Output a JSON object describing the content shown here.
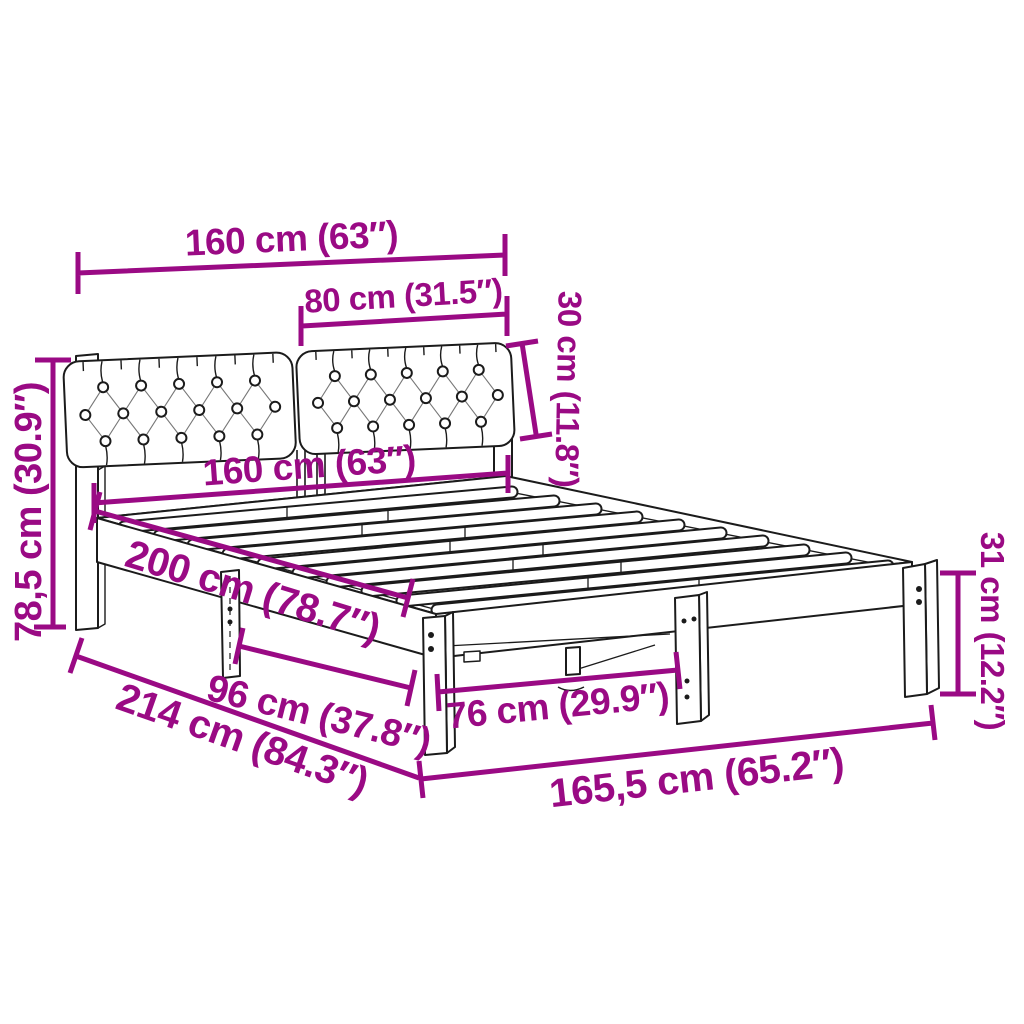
{
  "title": "Bed frame with tufted headboard - dimension diagram",
  "colors": {
    "dimension_accent": "#9a0a84",
    "line_art": "#1b1b1b",
    "background": "#ffffff"
  },
  "dimensions": {
    "headboard_width": "160 cm (63″)",
    "cushion_width": "80 cm (31.5″)",
    "cushion_height": "30 cm (11.8″)",
    "mattress_width": "160 cm (63″)",
    "headboard_height": "78,5 cm (30.9″)",
    "mattress_length": "200 cm (78.7″)",
    "side_leg_spacing": "96 cm (37.8″)",
    "total_length": "214 cm (84.3″)",
    "foot_leg_spacing": "76 cm (29.9″)",
    "frame_width": "165,5 cm (65.2″)",
    "frame_height": "31 cm (12.2″)"
  }
}
